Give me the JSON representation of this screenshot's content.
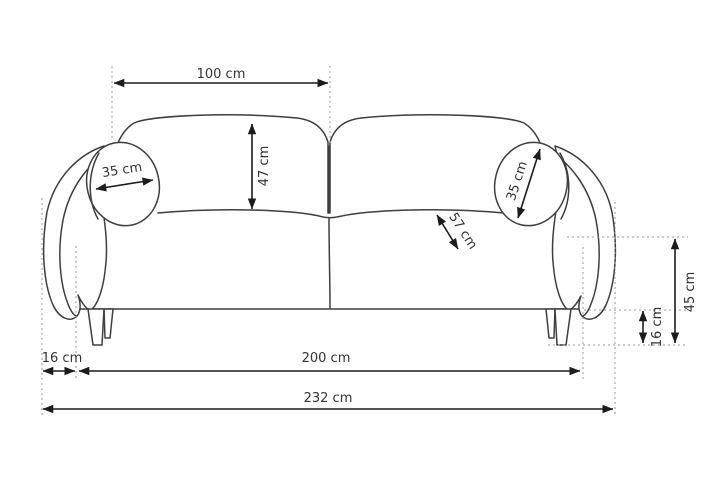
{
  "diagram": {
    "subject": "sofa dimension drawing",
    "unit": "cm"
  },
  "colors": {
    "outline": "#3e3e3e",
    "dimension_line": "#1c1c1c",
    "guide_line": "#999999",
    "label_text": "#333333",
    "background": "#ffffff"
  },
  "labels": {
    "backrest_width": "100 cm",
    "backrest_cushion_height": "47 cm",
    "left_pillow_diameter": "35 cm",
    "right_pillow_diameter": "35 cm",
    "seat_depth": "57 cm",
    "seat_height": "45 cm",
    "leg_height": "16 cm",
    "arm_overhang": "16 cm",
    "inner_width": "200 cm",
    "total_width": "232 cm"
  }
}
